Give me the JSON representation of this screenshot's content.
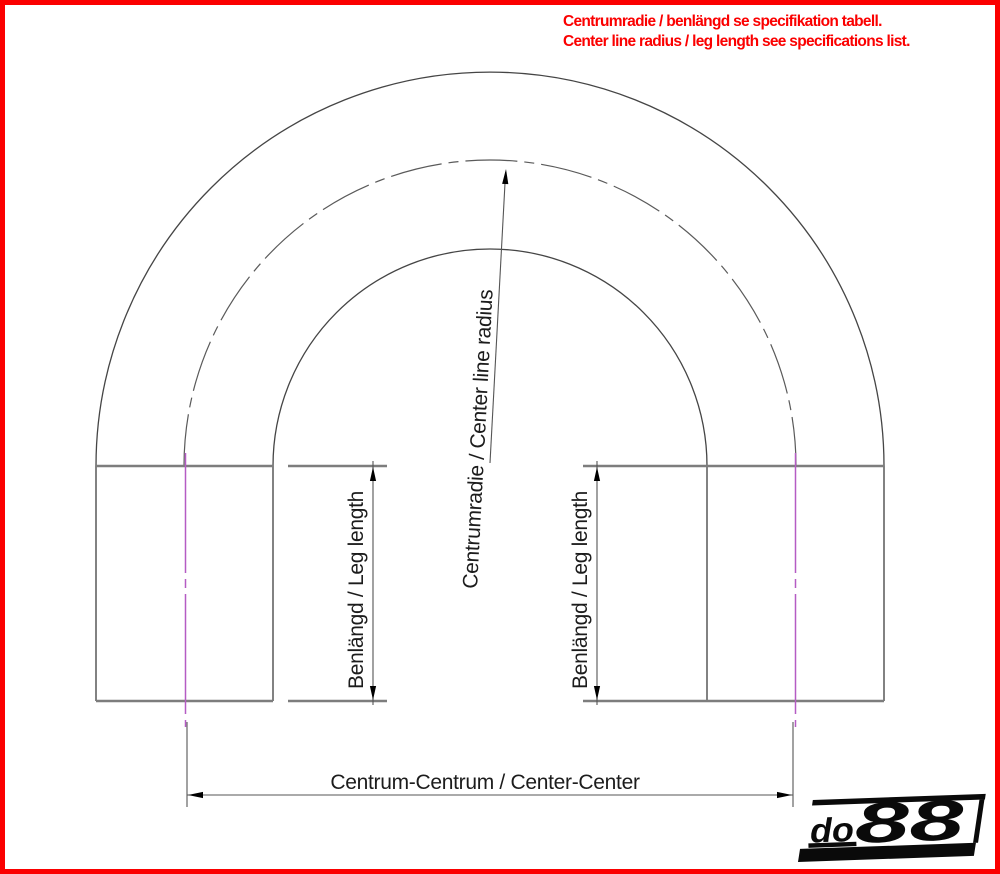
{
  "note": {
    "line1": "Centrumradie / benlängd se specifikation tabell.",
    "line2": "Center line radius / leg length see specifications list."
  },
  "dimensions": {
    "center_line_radius_label": "Centrumradie / Center line radius",
    "leg_length_left_label": "Benlängd / Leg length",
    "leg_length_right_label": "Benlängd / Leg length",
    "center_center_label": "Centrum-Centrum / Center-Center"
  },
  "logo": {
    "prefix": "do",
    "suffix": "88"
  },
  "colors": {
    "frame_red": "#fb0000",
    "note_red": "#fb0000",
    "centerline_magenta": "#b55cc4",
    "drawing_line_gray": "#4a4a4a",
    "transition_line_gray": "#7d7d7d",
    "logo_black": "#0a0a0a"
  }
}
